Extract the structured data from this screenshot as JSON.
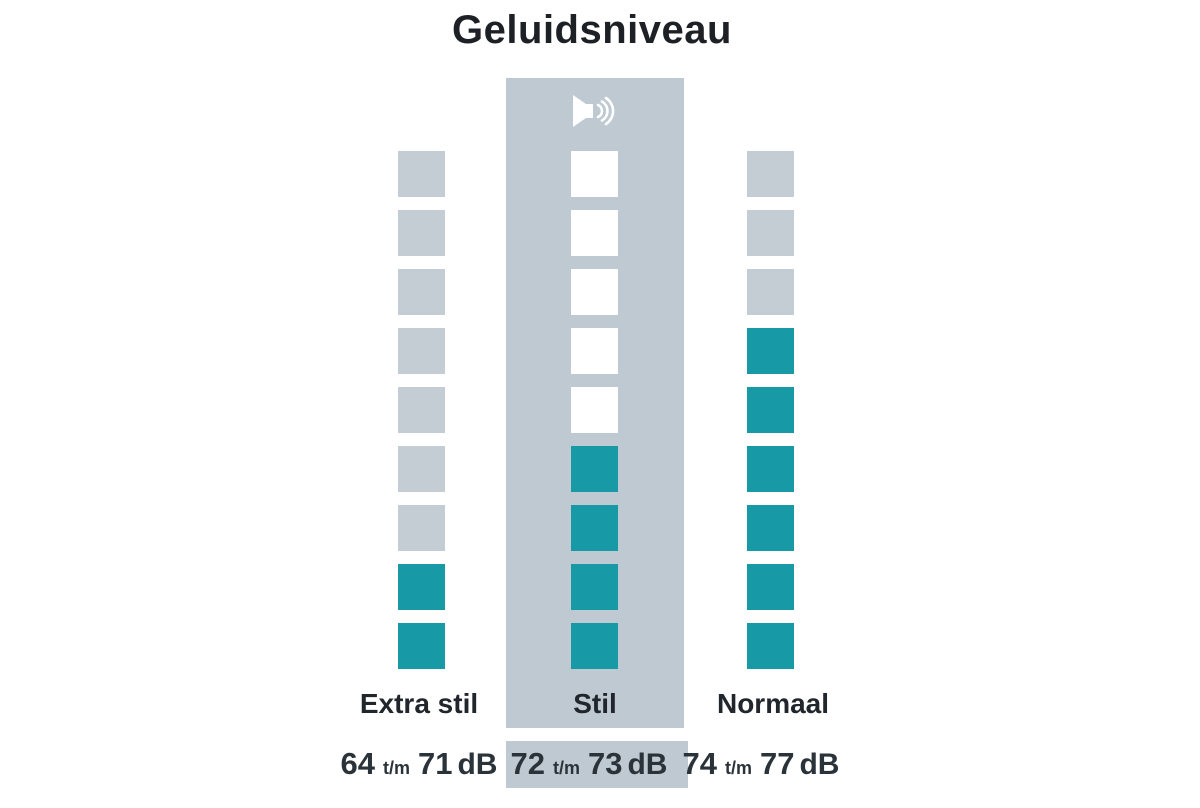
{
  "title": "Geluidsniveau",
  "colors": {
    "filled": "#1899A6",
    "empty_outer": "#C4CDD4",
    "empty_middle": "#FFFFFF",
    "band": "#BFC9D1",
    "background": "#FFFFFF",
    "icon": "#FFFFFF"
  },
  "chart_data": {
    "type": "bar",
    "title": "Geluidsniveau",
    "unit": "dB",
    "total_segments": 9,
    "legend_position": "none",
    "columns": [
      {
        "label": "Extra stil",
        "filled_segments": 2,
        "empty_color": "#C4CDD4",
        "highlighted": false,
        "range_from": "64",
        "range_separator": "t/m",
        "range_to": "71",
        "range_unit": "dB"
      },
      {
        "label": "Stil",
        "filled_segments": 4,
        "empty_color": "#FFFFFF",
        "highlighted": true,
        "icon": "speaker",
        "range_from": "72",
        "range_separator": "t/m",
        "range_to": "73",
        "range_unit": "dB"
      },
      {
        "label": "Normaal",
        "filled_segments": 6,
        "empty_color": "#C4CDD4",
        "highlighted": false,
        "range_from": "74",
        "range_separator": "t/m",
        "range_to": "77",
        "range_unit": "dB"
      }
    ]
  }
}
